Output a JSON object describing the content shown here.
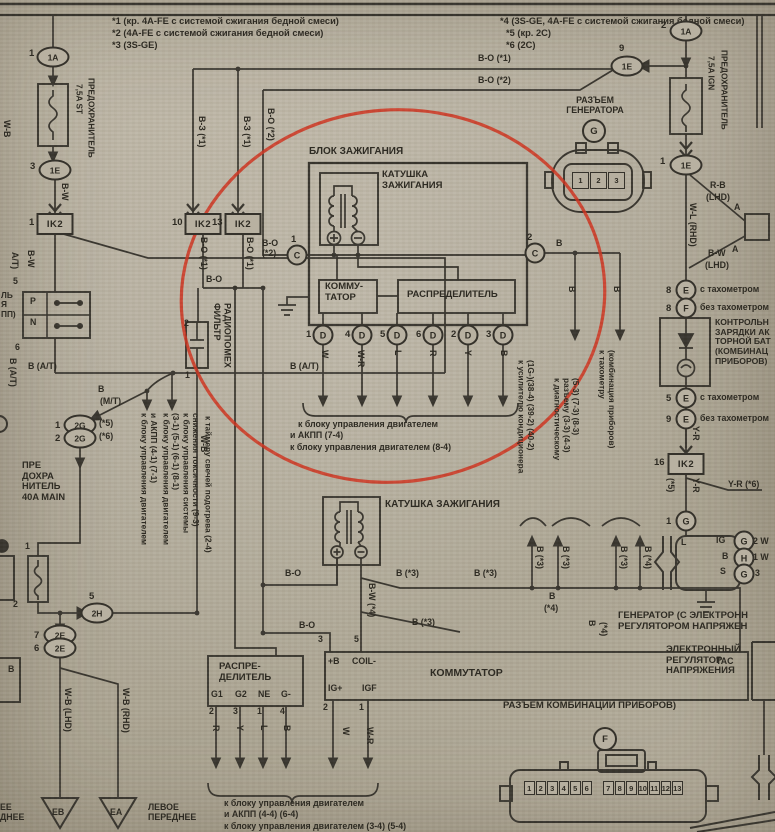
{
  "meta": {
    "document": "Схема системы зажигания (сканированная страница руководства)",
    "annotation_color": "#cf301c",
    "paper_color": "#b3ac9c",
    "ink_color": "#35322b"
  },
  "notes": [
    {
      "t": "*1 (кр. 4A-FE с системой сжигания бедной смеси)"
    },
    {
      "t": "*2 (4A-FE с системой сжигания бедной смеси)"
    },
    {
      "t": "*3 (3S-GE)"
    },
    {
      "t": "*4 (3S-GE, 4A-FE с системой сжигания бедной смеси)"
    },
    {
      "t": "*5 (кр. 2C)"
    },
    {
      "t": "*6 (2C)"
    }
  ],
  "labels": [
    {
      "n": "note-1",
      "t": "*1 (кр. 4A-FE с системой сжигания бедной смеси)",
      "x": 112,
      "y": 16,
      "s": 9.3
    },
    {
      "n": "note-2",
      "t": "*2 (4A-FE с системой сжигания бедной смеси)",
      "x": 112,
      "y": 28,
      "s": 9.3
    },
    {
      "n": "note-3",
      "t": "*3 (3S-GE)",
      "x": 112,
      "y": 40,
      "s": 9.3
    },
    {
      "n": "note-4",
      "t": "*4 (3S-GE, 4A-FE с системой сжигания бедной смеси)",
      "x": 500,
      "y": 16,
      "s": 9.3
    },
    {
      "n": "note-5",
      "t": "*5 (кр. 2C)",
      "x": 506,
      "y": 28,
      "s": 9.3
    },
    {
      "n": "note-6",
      "t": "*6 (2C)",
      "x": 506,
      "y": 40,
      "s": 9.3
    },
    {
      "n": "wire",
      "t": "B-O (*1)",
      "x": 478,
      "y": 54
    },
    {
      "n": "wire",
      "t": "B-O (*2)",
      "x": 478,
      "y": 76
    },
    {
      "n": "component",
      "t": "РАЗЪЕМ\nГЕНЕРАТОРА",
      "x": 552,
      "y": 96,
      "ctr": 1,
      "w": 86
    },
    {
      "n": "component",
      "t": "ПРЕДОХРАНИТЕЛЬ",
      "x": 86,
      "y": 78,
      "v": 1,
      "s": 8.3
    },
    {
      "n": "component",
      "t": "7,5A ST",
      "x": 74,
      "y": 84,
      "v": 1,
      "s": 8.3
    },
    {
      "n": "component",
      "t": "ПРЕДОХРАНИТЕЛЬ",
      "x": 719,
      "y": 50,
      "v": 1,
      "s": 8.3
    },
    {
      "n": "component",
      "t": "7,5A IGN",
      "x": 706,
      "y": 56,
      "v": 1,
      "s": 8.3
    },
    {
      "n": "wire",
      "t": "B-W",
      "x": 59,
      "y": 183,
      "v": 1
    },
    {
      "n": "wire",
      "t": "В-З (*1)",
      "x": 196,
      "y": 116,
      "v": 1
    },
    {
      "n": "wire",
      "t": "В-З (*1)",
      "x": 241,
      "y": 116,
      "v": 1
    },
    {
      "n": "wire",
      "t": "B-O (*2)",
      "x": 265,
      "y": 108,
      "v": 1
    },
    {
      "n": "wire",
      "t": "B-O (*1)",
      "x": 198,
      "y": 237,
      "v": 1
    },
    {
      "n": "wire",
      "t": "B-O (*1)",
      "x": 244,
      "y": 237,
      "v": 1
    },
    {
      "n": "wire",
      "t": "B-O",
      "x": 206,
      "y": 275
    },
    {
      "n": "wire",
      "t": "B-O\n(*2)",
      "x": 262,
      "y": 239
    },
    {
      "n": "component",
      "t": "БЛОК ЗАЖИГАНИЯ",
      "x": 309,
      "y": 146,
      "s": 10
    },
    {
      "n": "component",
      "t": "КАТУШКА\nЗАЖИГАНИЯ",
      "x": 382,
      "y": 170,
      "s": 9.5
    },
    {
      "n": "component",
      "t": "КОММУ-\nТАТОР",
      "x": 325,
      "y": 282,
      "s": 9.5
    },
    {
      "n": "component",
      "t": "РАСПРЕДЕЛИТЕЛЬ",
      "x": 407,
      "y": 290,
      "s": 9.5
    },
    {
      "n": "wire",
      "t": "B",
      "x": 556,
      "y": 239
    },
    {
      "n": "wire",
      "t": "B",
      "x": 566,
      "y": 286,
      "v": 1
    },
    {
      "n": "wire",
      "t": "B",
      "x": 611,
      "y": 286,
      "v": 1
    },
    {
      "n": "wire",
      "t": "W",
      "x": 319,
      "y": 350,
      "v": 1
    },
    {
      "n": "wire",
      "t": "W-R",
      "x": 355,
      "y": 350,
      "v": 1
    },
    {
      "n": "wire",
      "t": "L",
      "x": 392,
      "y": 350,
      "v": 1
    },
    {
      "n": "wire",
      "t": "R",
      "x": 427,
      "y": 350,
      "v": 1
    },
    {
      "n": "wire",
      "t": "Y",
      "x": 462,
      "y": 350,
      "v": 1
    },
    {
      "n": "wire",
      "t": "B",
      "x": 498,
      "y": 350,
      "v": 1
    },
    {
      "n": "dest",
      "t": "к блоку управления двигателем",
      "x": 298,
      "y": 420
    },
    {
      "n": "dest",
      "t": "и АКПП (7-4)",
      "x": 290,
      "y": 431
    },
    {
      "n": "dest",
      "t": "к блоку управления двигателем (8-4)",
      "x": 290,
      "y": 443
    },
    {
      "n": "dest",
      "t": "к усилителю кондиционера\n(1G-)(38-4) (39-2) (40-2)",
      "x": 516,
      "y": 360,
      "v": 1,
      "s": 8.3
    },
    {
      "n": "dest",
      "t": "к диагностическому\nразъему (3-3) (4-3)\n(5-3) (7-3) (8-3)",
      "x": 552,
      "y": 378,
      "v": 1,
      "s": 8.3
    },
    {
      "n": "dest",
      "t": "к тахометру\n(комбинация приборов)",
      "x": 597,
      "y": 350,
      "v": 1,
      "s": 8.3
    },
    {
      "n": "wire",
      "t": "R-B",
      "x": 710,
      "y": 181
    },
    {
      "n": "wire",
      "t": "(LHD)",
      "x": 706,
      "y": 193
    },
    {
      "n": "pin-label",
      "t": "A",
      "x": 734,
      "y": 203
    },
    {
      "n": "pin-label",
      "t": "A",
      "x": 732,
      "y": 245
    },
    {
      "n": "wire",
      "t": "B-W",
      "x": 708,
      "y": 249
    },
    {
      "n": "wire",
      "t": "(LHD)",
      "x": 705,
      "y": 261
    },
    {
      "n": "wire",
      "t": "W-L (RHD)",
      "x": 687,
      "y": 203,
      "v": 1
    },
    {
      "n": "variant",
      "t": "с тахометром",
      "x": 700,
      "y": 285
    },
    {
      "n": "variant",
      "t": "без тахометром",
      "x": 700,
      "y": 303
    },
    {
      "n": "component",
      "t": "КОНТРОЛЬН\nЗАРЯДКИ АК\nТОРНОЙ БАТ\n(КОМБИНАЦ\nПРИБОРОВ)",
      "x": 715,
      "y": 318,
      "s": 8.6
    },
    {
      "n": "variant",
      "t": "с тахометром",
      "x": 700,
      "y": 393
    },
    {
      "n": "variant",
      "t": "без тахометром",
      "x": 700,
      "y": 414
    },
    {
      "n": "wire",
      "t": "Y-R",
      "x": 690,
      "y": 426,
      "v": 1
    },
    {
      "n": "wire",
      "t": "Y-R",
      "x": 690,
      "y": 478,
      "v": 1
    },
    {
      "n": "wire",
      "t": "(*5)",
      "x": 665,
      "y": 478,
      "v": 1
    },
    {
      "n": "wire",
      "t": "Y-R (*6)",
      "x": 728,
      "y": 480
    },
    {
      "n": "pin-label",
      "t": "L",
      "x": 681,
      "y": 538
    },
    {
      "n": "pin-label",
      "t": "IG",
      "x": 716,
      "y": 536
    },
    {
      "n": "pin-label",
      "t": "B",
      "x": 722,
      "y": 552
    },
    {
      "n": "pin-label",
      "t": "S",
      "x": 720,
      "y": 567
    },
    {
      "n": "pin-label",
      "t": "2 W",
      "x": 753,
      "y": 537
    },
    {
      "n": "pin-label",
      "t": "1 W",
      "x": 753,
      "y": 553
    },
    {
      "n": "pin-label",
      "t": "3",
      "x": 755,
      "y": 569
    },
    {
      "n": "component",
      "t": "ГЕНЕРАТОР (С ЭЛЕКТРОНН\nРЕГУЛЯТОРОМ НАПРЯЖЕН",
      "x": 618,
      "y": 611,
      "s": 9.5
    },
    {
      "n": "component",
      "t": "ЭЛЕКТРОННЫЙ\nРЕГУЛЯТОР\nНАПРЯЖЕНИЯ",
      "x": 666,
      "y": 645,
      "s": 9.5
    },
    {
      "n": "wire",
      "t": "B (*3)",
      "x": 534,
      "y": 546,
      "v": 1
    },
    {
      "n": "wire",
      "t": "B (*3)",
      "x": 560,
      "y": 546,
      "v": 1
    },
    {
      "n": "wire",
      "t": "B (*3)",
      "x": 618,
      "y": 546,
      "v": 1
    },
    {
      "n": "wire",
      "t": "B (*4)",
      "x": 642,
      "y": 546,
      "v": 1
    },
    {
      "n": "wire",
      "t": "B",
      "x": 549,
      "y": 592
    },
    {
      "n": "wire",
      "t": "(*4)",
      "x": 544,
      "y": 604
    },
    {
      "n": "wire",
      "t": "B",
      "x": 586,
      "y": 620,
      "v": 1
    },
    {
      "n": "wire",
      "t": "(*4)",
      "x": 598,
      "y": 622,
      "v": 1
    },
    {
      "n": "wire",
      "t": "B-O",
      "x": 285,
      "y": 569
    },
    {
      "n": "wire",
      "t": "B (*3)",
      "x": 396,
      "y": 569
    },
    {
      "n": "wire",
      "t": "B (*3)",
      "x": 474,
      "y": 569
    },
    {
      "n": "wire",
      "t": "B (*3)",
      "x": 412,
      "y": 618
    },
    {
      "n": "wire",
      "t": "B-O",
      "x": 299,
      "y": 621
    },
    {
      "n": "wire",
      "t": "B-W (*4)",
      "x": 366,
      "y": 583,
      "v": 1
    },
    {
      "n": "component",
      "t": "КАТУШКА ЗАЖИГАНИЯ",
      "x": 385,
      "y": 499,
      "s": 10
    },
    {
      "n": "pin-label",
      "t": "3",
      "x": 318,
      "y": 635
    },
    {
      "n": "pin-label",
      "t": "5",
      "x": 354,
      "y": 635
    },
    {
      "n": "pin-label",
      "t": "+B",
      "x": 328,
      "y": 657
    },
    {
      "n": "pin-label",
      "t": "COIL-",
      "x": 352,
      "y": 657
    },
    {
      "n": "component",
      "t": "КОММУТАТОР",
      "x": 430,
      "y": 668,
      "s": 10.5
    },
    {
      "n": "pin-label",
      "t": "TAC",
      "x": 716,
      "y": 657
    },
    {
      "n": "pin-label",
      "t": "IG+",
      "x": 328,
      "y": 684
    },
    {
      "n": "pin-label",
      "t": "IGF",
      "x": 362,
      "y": 684
    },
    {
      "n": "pin-label",
      "t": "2",
      "x": 323,
      "y": 703
    },
    {
      "n": "pin-label",
      "t": "1",
      "x": 359,
      "y": 703
    },
    {
      "n": "wire",
      "t": "W",
      "x": 340,
      "y": 727,
      "v": 1
    },
    {
      "n": "wire",
      "t": "W-R",
      "x": 364,
      "y": 727,
      "v": 1
    },
    {
      "n": "component",
      "t": "РАСПРЕ-\nДЕЛИТЕЛЬ",
      "x": 219,
      "y": 662,
      "s": 9.5
    },
    {
      "n": "pin-label",
      "t": "G1",
      "x": 211,
      "y": 690
    },
    {
      "n": "pin-label",
      "t": "G2",
      "x": 235,
      "y": 690
    },
    {
      "n": "pin-label",
      "t": "NE",
      "x": 258,
      "y": 690
    },
    {
      "n": "pin-label",
      "t": "G-",
      "x": 281,
      "y": 690
    },
    {
      "n": "pin-label",
      "t": "2",
      "x": 209,
      "y": 707
    },
    {
      "n": "pin-label",
      "t": "3",
      "x": 233,
      "y": 707
    },
    {
      "n": "pin-label",
      "t": "1",
      "x": 257,
      "y": 707
    },
    {
      "n": "pin-label",
      "t": "4",
      "x": 280,
      "y": 707
    },
    {
      "n": "wire",
      "t": "R",
      "x": 210,
      "y": 725,
      "v": 1
    },
    {
      "n": "wire",
      "t": "Y",
      "x": 234,
      "y": 725,
      "v": 1
    },
    {
      "n": "wire",
      "t": "L",
      "x": 258,
      "y": 725,
      "v": 1
    },
    {
      "n": "wire",
      "t": "B",
      "x": 281,
      "y": 725,
      "v": 1
    },
    {
      "n": "dest",
      "t": "к блоку управления двигателем",
      "x": 224,
      "y": 799
    },
    {
      "n": "dest",
      "t": "и АКПП (4-4) (6-4)",
      "x": 224,
      "y": 810
    },
    {
      "n": "dest",
      "t": "к блоку управления двигателем (3-4) (5-4)",
      "x": 224,
      "y": 822
    },
    {
      "n": "component",
      "t": "РАЗЪЕМ КОМБИНАЦИИ ПРИБОРОВ)",
      "x": 503,
      "y": 701,
      "s": 9.5
    },
    {
      "n": "dest",
      "t": "ЛЕВОЕ\nПЕРЕДНЕЕ",
      "x": 148,
      "y": 803
    },
    {
      "n": "dest",
      "t": "ЕЕ\nДНЕЕ",
      "x": 0,
      "y": 803
    },
    {
      "n": "wire",
      "t": "A/T)",
      "x": 9,
      "y": 252,
      "v": 1
    },
    {
      "n": "wire",
      "t": "B-W",
      "x": 25,
      "y": 250,
      "v": 1
    },
    {
      "n": "component",
      "t": "ЛЬ\nЯ\nПП)",
      "x": 1,
      "y": 291,
      "s": 8.3
    },
    {
      "n": "pin-label",
      "t": "P",
      "x": 30,
      "y": 297
    },
    {
      "n": "pin-label",
      "t": "N",
      "x": 30,
      "y": 318
    },
    {
      "n": "pin-label",
      "t": "5",
      "x": 13,
      "y": 277
    },
    {
      "n": "pin-label",
      "t": "6",
      "x": 15,
      "y": 343
    },
    {
      "n": "wire",
      "t": "B (A/T)",
      "x": 7,
      "y": 358,
      "v": 1
    },
    {
      "n": "wire",
      "t": "B (A/T)",
      "x": 28,
      "y": 362
    },
    {
      "n": "wire",
      "t": "B (A/T)",
      "x": 290,
      "y": 362
    },
    {
      "n": "wire",
      "t": "B",
      "x": 98,
      "y": 385
    },
    {
      "n": "wire",
      "t": "(M/T)",
      "x": 100,
      "y": 397
    },
    {
      "n": "variant",
      "t": "(*5)",
      "x": 99,
      "y": 419
    },
    {
      "n": "variant",
      "t": "(*6)",
      "x": 99,
      "y": 432
    },
    {
      "n": "component",
      "t": "ПРЕ\nДОХРА\nНИТЕЛЬ\n40A MAIN",
      "x": 22,
      "y": 460,
      "s": 9.3
    },
    {
      "n": "pin-label",
      "t": "1",
      "x": 25,
      "y": 542
    },
    {
      "n": "pin-label",
      "t": "2",
      "x": 13,
      "y": 600
    },
    {
      "n": "wire",
      "t": "W-B",
      "x": 198,
      "y": 435,
      "v": 1
    },
    {
      "n": "dest",
      "t": "к блоку управления двигателем\nи АКПП (4-1) (7-1)",
      "x": 139,
      "y": 413,
      "v": 1,
      "s": 8.3
    },
    {
      "n": "dest",
      "t": "к блоку управления двигателем\n(3-1) (5-1) (6-1) (8-1)",
      "x": 161,
      "y": 413,
      "v": 1,
      "s": 8.3
    },
    {
      "n": "dest",
      "t": "к блоку управления системы\nснижения токсичности (9-3)",
      "x": 181,
      "y": 413,
      "v": 1,
      "s": 8.3
    },
    {
      "n": "dest",
      "t": "к таймеру свечей подогрева (2-4)",
      "x": 203,
      "y": 416,
      "v": 1,
      "s": 8.3
    },
    {
      "n": "wire",
      "t": "W-B (LHD)",
      "x": 62,
      "y": 688,
      "v": 1
    },
    {
      "n": "wire",
      "t": "W-B (RHD)",
      "x": 120,
      "y": 688,
      "v": 1
    },
    {
      "n": "ground",
      "t": "EB",
      "x": 52,
      "y": 808
    },
    {
      "n": "ground",
      "t": "EA",
      "x": 110,
      "y": 808
    },
    {
      "n": "wire",
      "t": "W-B",
      "x": 1,
      "y": 120,
      "v": 1
    },
    {
      "n": "wire",
      "t": "B",
      "x": 8,
      "y": 665
    },
    {
      "n": "component",
      "t": "ФИЛЬТР\nРАДИОПОМЕХ",
      "x": 212,
      "y": 303,
      "v": 1,
      "s": 9
    },
    {
      "n": "pin-label",
      "t": "2",
      "x": 184,
      "y": 319
    },
    {
      "n": "pin-label",
      "t": "1",
      "x": 185,
      "y": 371
    }
  ],
  "connectors": [
    {
      "l": "1A",
      "sh": "oval",
      "x": 53,
      "y": 57,
      "pin": "1",
      "px": -24,
      "py": -9
    },
    {
      "l": "1A",
      "sh": "oval",
      "x": 686,
      "y": 31,
      "pin": "2",
      "px": -25,
      "py": -11
    },
    {
      "l": "1E",
      "sh": "oval",
      "x": 55,
      "y": 170,
      "pin": "3",
      "px": -25,
      "py": -9
    },
    {
      "l": "1E",
      "sh": "oval",
      "x": 627,
      "y": 66,
      "pin": "9",
      "px": -8,
      "py": -23
    },
    {
      "l": "1E",
      "sh": "oval",
      "x": 686,
      "y": 165,
      "pin": "1",
      "px": -26,
      "py": -9
    },
    {
      "l": "IK2",
      "sh": "rect",
      "x": 55,
      "y": 224,
      "pin": "1",
      "px": -26,
      "py": -7
    },
    {
      "l": "IK2",
      "sh": "rect",
      "x": 203,
      "y": 224,
      "pin": "10",
      "px": -31,
      "py": -7
    },
    {
      "l": "IK2",
      "sh": "rect",
      "x": 243,
      "y": 224,
      "pin": "13",
      "px": -31,
      "py": -7
    },
    {
      "l": "IK2",
      "sh": "rect",
      "x": 686,
      "y": 464,
      "pin": "16",
      "px": -32,
      "py": -7
    },
    {
      "l": "C",
      "sh": "circle",
      "x": 297,
      "y": 255,
      "pin": "1",
      "px": -6,
      "py": -21
    },
    {
      "l": "C",
      "sh": "circle",
      "x": 535,
      "y": 253,
      "pin": "2",
      "px": -8,
      "py": -21
    },
    {
      "l": "D",
      "sh": "circle",
      "x": 323,
      "y": 335,
      "pin": "1",
      "px": -17,
      "py": -6
    },
    {
      "l": "D",
      "sh": "circle",
      "x": 362,
      "y": 335,
      "pin": "4",
      "px": -17,
      "py": -6
    },
    {
      "l": "D",
      "sh": "circle",
      "x": 397,
      "y": 335,
      "pin": "5",
      "px": -17,
      "py": -6
    },
    {
      "l": "D",
      "sh": "circle",
      "x": 433,
      "y": 335,
      "pin": "6",
      "px": -17,
      "py": -6
    },
    {
      "l": "D",
      "sh": "circle",
      "x": 468,
      "y": 335,
      "pin": "2",
      "px": -17,
      "py": -6
    },
    {
      "l": "D",
      "sh": "circle",
      "x": 503,
      "y": 335,
      "pin": "3",
      "px": -17,
      "py": -6
    },
    {
      "l": "G",
      "sh": "bigcircle",
      "x": 594,
      "y": 131
    },
    {
      "l": "E",
      "sh": "circle",
      "x": 686,
      "y": 290,
      "pin": "8",
      "px": -20,
      "py": -5
    },
    {
      "l": "F",
      "sh": "circle",
      "x": 686,
      "y": 308,
      "pin": "8",
      "px": -20,
      "py": -5
    },
    {
      "l": "E",
      "sh": "circle",
      "x": 686,
      "y": 398,
      "pin": "5",
      "px": -20,
      "py": -5
    },
    {
      "l": "E",
      "sh": "circle",
      "x": 686,
      "y": 419,
      "pin": "9",
      "px": -20,
      "py": -5
    },
    {
      "l": "G",
      "sh": "circle",
      "x": 686,
      "y": 521,
      "pin": "1",
      "px": -20,
      "py": -5
    },
    {
      "l": "G",
      "sh": "circle",
      "x": 744,
      "y": 541
    },
    {
      "l": "H",
      "sh": "circle",
      "x": 744,
      "y": 558
    },
    {
      "l": "G",
      "sh": "circle",
      "x": 744,
      "y": 574
    },
    {
      "l": "2G",
      "sh": "oval",
      "x": 80,
      "y": 425,
      "pin": "1",
      "px": -25,
      "py": -5
    },
    {
      "l": "2G",
      "sh": "oval",
      "x": 80,
      "y": 438,
      "pin": "2",
      "px": -25,
      "py": -5
    },
    {
      "l": "2H",
      "sh": "oval",
      "x": 97,
      "y": 613,
      "pin": "5",
      "px": -8,
      "py": -22
    },
    {
      "l": "2E",
      "sh": "oval",
      "x": 60,
      "y": 635,
      "pin": "7",
      "px": -26,
      "py": -5
    },
    {
      "l": "2E",
      "sh": "oval",
      "x": 60,
      "y": 648,
      "pin": "6",
      "px": -26,
      "py": -5
    },
    {
      "l": "F",
      "sh": "bigcircle",
      "x": 605,
      "y": 739
    }
  ],
  "generator_connector_pins": [
    "1",
    "2",
    "3"
  ],
  "combo_connector_pins_a": [
    "1",
    "2",
    "3",
    "4",
    "5",
    "6"
  ],
  "combo_connector_pins_b": [
    "7",
    "8",
    "9",
    "10",
    "11",
    "12",
    "13"
  ]
}
